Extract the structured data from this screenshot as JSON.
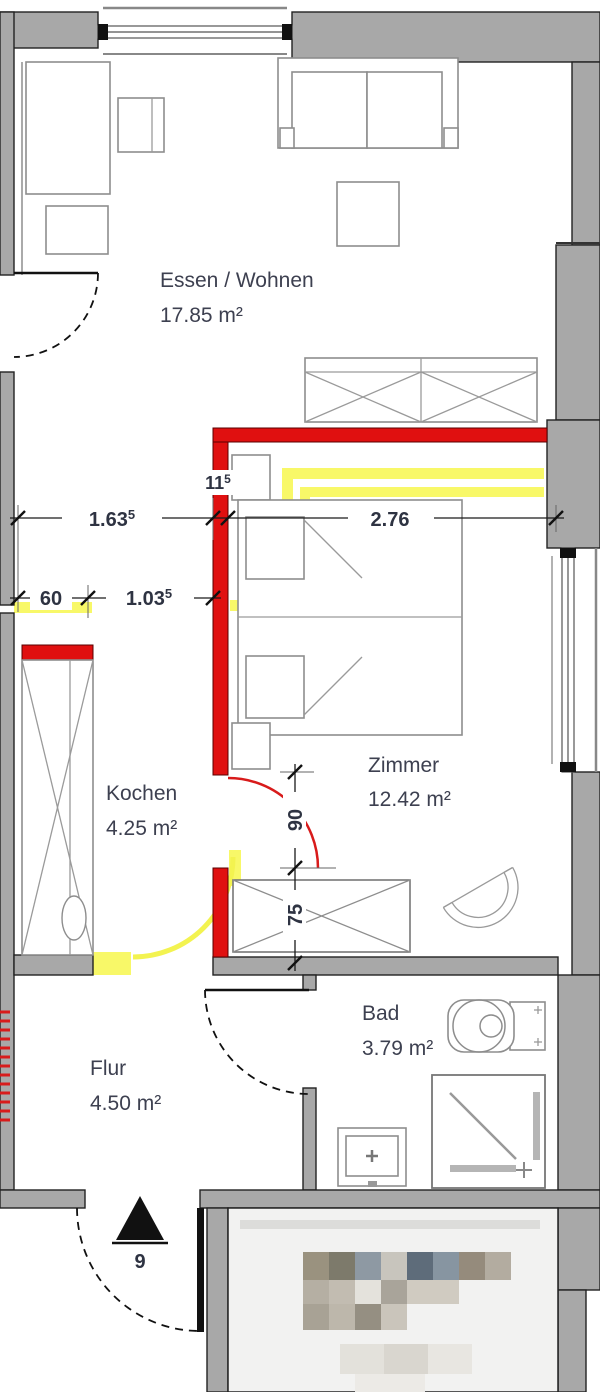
{
  "plan": {
    "title": "Wohnungsgrundriss",
    "rooms": [
      {
        "id": "essen_wohnen",
        "name": "Essen / Wohnen",
        "area": "17.85 m²"
      },
      {
        "id": "kochen",
        "name": "Kochen",
        "area": "4.25 m²"
      },
      {
        "id": "zimmer",
        "name": "Zimmer",
        "area": "12.42 m²"
      },
      {
        "id": "bad",
        "name": "Bad",
        "area": "3.79 m²"
      },
      {
        "id": "flur",
        "name": "Flur",
        "area": "4.50 m²"
      }
    ],
    "dimensions": {
      "d163": {
        "main": "1.63",
        "sup": "5"
      },
      "d11": {
        "main": "11",
        "sup": "5"
      },
      "d276": {
        "main": "2.76",
        "sup": ""
      },
      "d60": {
        "main": "60",
        "sup": ""
      },
      "d103": {
        "main": "1.03",
        "sup": "5"
      },
      "d90": {
        "main": "90",
        "sup": ""
      },
      "d75": {
        "main": "75",
        "sup": ""
      },
      "entrance_number": "9"
    },
    "legend_colors": {
      "existing_wall": "#a8a8a8",
      "new_wall_red": "#e01010",
      "demolished_yellow": "#f8f868",
      "dimension_text": "#2e3342",
      "label_text": "#3d4050"
    }
  }
}
